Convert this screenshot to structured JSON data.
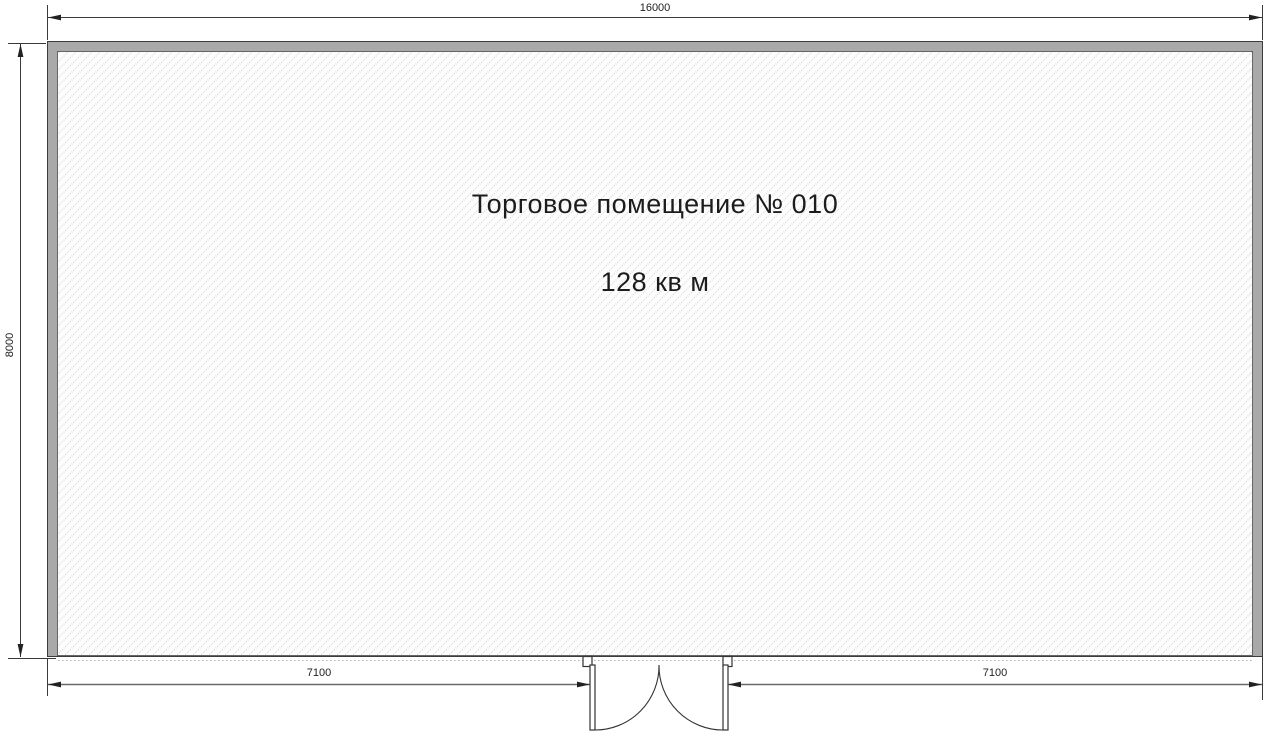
{
  "plan": {
    "room": {
      "label": "Торговое помещение № 010",
      "area": "128 кв м"
    },
    "dimensions": {
      "top_width": "16000",
      "left_height": "8000",
      "bottom_left_segment": "7100",
      "bottom_right_segment": "7100"
    },
    "door": {
      "type": "double-swing-entrance-door"
    },
    "colors": {
      "wall_fill": "#a9a9a9",
      "wall_edge": "#3c3c3c",
      "interior_bg": "#fdfdfd",
      "hatch_line": "#c9d3c9",
      "dimension_line": "#444444",
      "storefront_dashed": "#b0b0b0",
      "label_text": "#1c1c1c"
    }
  }
}
